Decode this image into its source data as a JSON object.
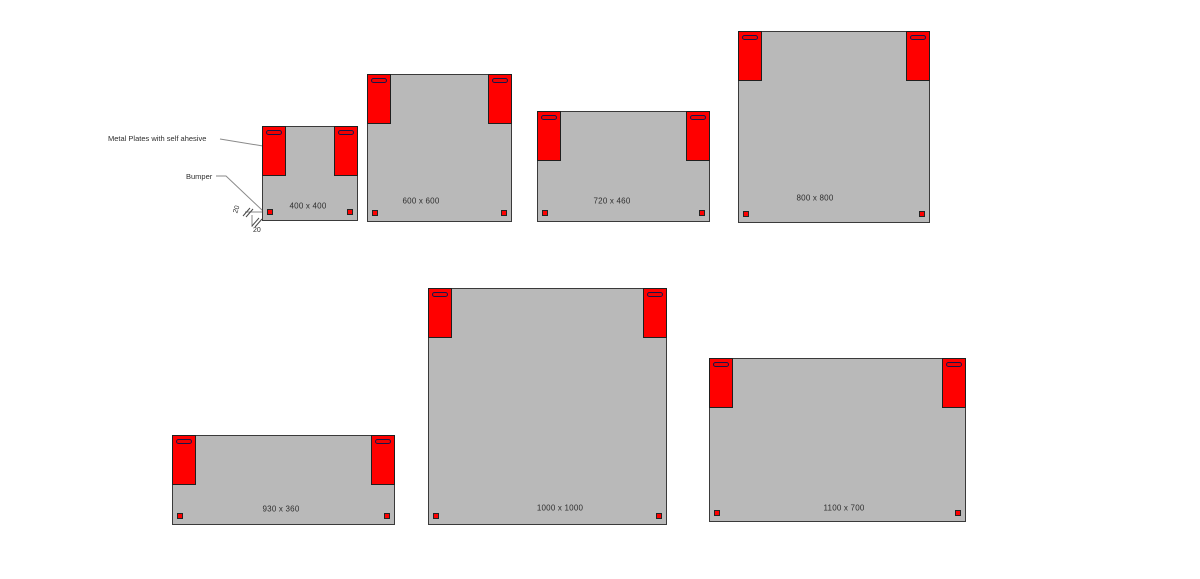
{
  "annotations": {
    "metal_plates": "Metal Plates with self ahesive",
    "bumper": "Bumper",
    "dim_left": "20",
    "dim_bottom": "20"
  },
  "panels": [
    {
      "label": "400 x 400"
    },
    {
      "label": "600 x 600"
    },
    {
      "label": "720 x 460"
    },
    {
      "label": "800 x 800"
    },
    {
      "label": "930 x 360"
    },
    {
      "label": "1000 x 1000"
    },
    {
      "label": "1100 x 700"
    }
  ],
  "colors": {
    "background": "#ffffff",
    "panel_fill": "#b9b9b9",
    "panel_border": "#3a3a3a",
    "plate_fill": "#ff0000",
    "slot_border": "#16164a",
    "bumper_fill": "#ff0000",
    "leader_line": "#8a8a8a",
    "text": "#2e2e2e"
  }
}
